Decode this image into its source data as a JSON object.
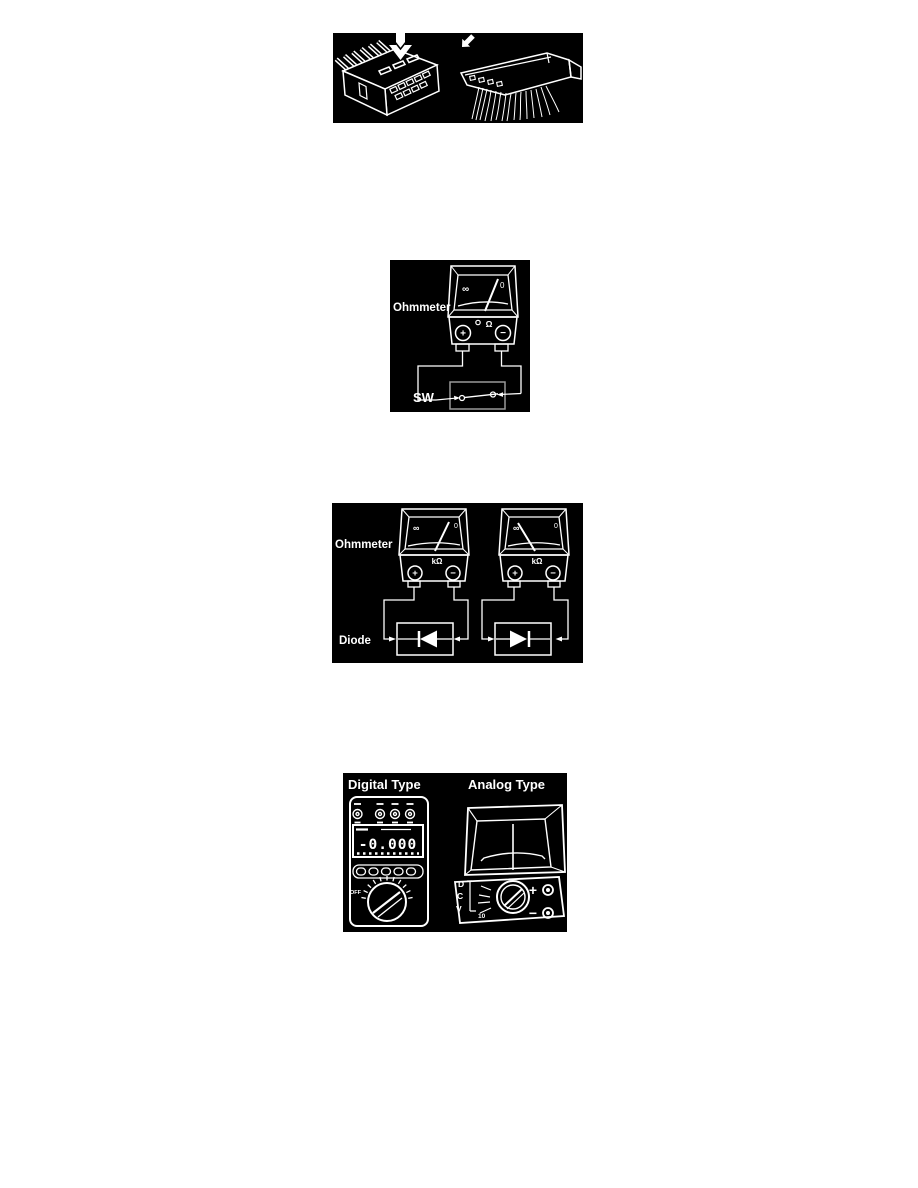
{
  "page": {
    "background": "#ffffff",
    "figure_background": "#000000",
    "line_color": "#ffffff"
  },
  "figure_switch_test": {
    "ohmmeter_label": "Ohmmeter",
    "switch_label": "SW",
    "meter": {
      "scale_left": "∞",
      "scale_right": "0",
      "unit": "Ω",
      "terminal_positive": "+",
      "terminal_negative": "−"
    }
  },
  "figure_diode_test": {
    "ohmmeter_label": "Ohmmeter",
    "diode_label": "Diode",
    "meters": [
      {
        "scale_left": "∞",
        "scale_right": "0",
        "unit": "kΩ",
        "terminal_positive": "+",
        "terminal_negative": "−"
      },
      {
        "scale_left": "∞",
        "scale_right": "0",
        "unit": "kΩ",
        "terminal_positive": "+",
        "terminal_negative": "−"
      }
    ]
  },
  "figure_multimeters": {
    "digital_title": "Digital Type",
    "analog_title": "Analog Type",
    "digital": {
      "display_value": "-0.000",
      "dial_off_label": "OFF"
    },
    "analog": {
      "scale_letters": [
        "D",
        "C",
        "V"
      ],
      "range_label": "10",
      "terminal_positive": "+",
      "terminal_negative": "−"
    }
  }
}
